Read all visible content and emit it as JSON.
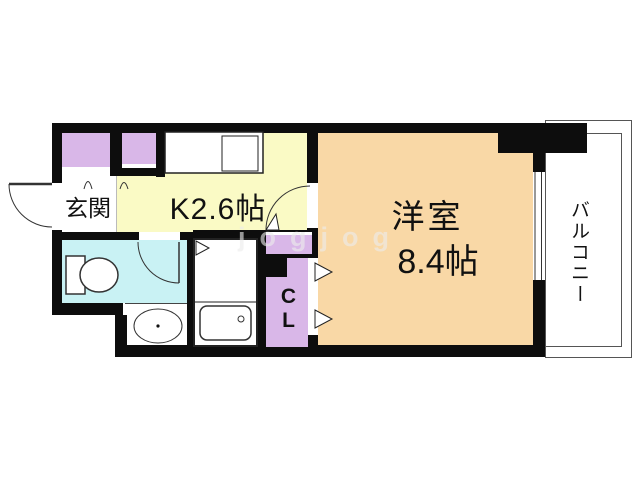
{
  "floorplan": {
    "title": "1K apartment floor plan",
    "labels": {
      "genkan": "玄関",
      "kitchen": "K2.6帖",
      "room_name": "洋室",
      "room_size": "8.4帖",
      "closet": "CL",
      "balcony": "バルコニー"
    },
    "rooms": [
      {
        "name": "entrance",
        "label": "玄関"
      },
      {
        "name": "kitchen",
        "label": "K2.6帖",
        "size_jo": 2.6
      },
      {
        "name": "western-room",
        "label": "洋室 8.4帖",
        "size_jo": 8.4
      },
      {
        "name": "bathroom",
        "label": ""
      },
      {
        "name": "closet",
        "label": "CL"
      },
      {
        "name": "balcony",
        "label": "バルコニー"
      }
    ],
    "watermark": "jogjog",
    "colors": {
      "wall": "#0d0d0d",
      "kitchen_fill": "#fafac5",
      "room_fill": "#f9d8a6",
      "bathroom_fill": "#c9f2f4",
      "storage_fill": "#d9b7e8",
      "fixture_line": "#333333",
      "balcony_line": "#555555",
      "background": "#ffffff"
    }
  }
}
